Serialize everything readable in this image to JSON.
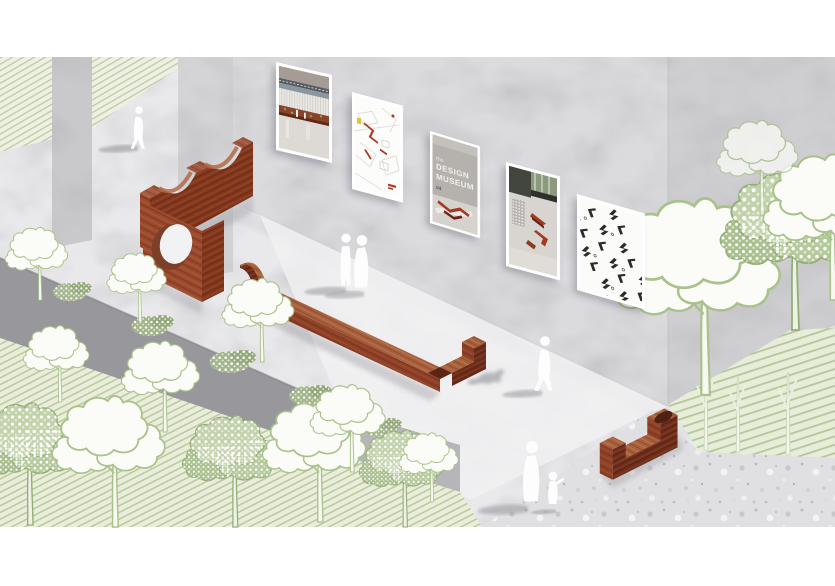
{
  "scene": {
    "description": "Axonometric architectural illustration of an outdoor Design Museum exhibition: brick arch furniture, long timber benches, poster gallery on a concrete wall, line-drawn trees and white visitor silhouettes",
    "style": "architectural collage rendering"
  },
  "wall_gallery": {
    "posters": [
      {
        "label": "interior perspective render with timber counter"
      },
      {
        "label": "site plan with red bench layout marks"
      },
      {
        "label": "museum concrete facade photo",
        "text_small": "the",
        "text_line1": "DESIGN",
        "text_line2": "MUSEUM",
        "text_tag": "#4"
      },
      {
        "label": "interior axonometric with red benches and dotted caption"
      },
      {
        "label": "bench module pattern specimen sheet"
      }
    ]
  },
  "objects": {
    "brick_arch_wall": "scalloped brick bench wall",
    "brick_hole_slab": "brick slab with circular opening",
    "long_bench": "long timber chaise bench with hook end",
    "hook_bench": "J-shaped timber bench"
  },
  "figures": [
    {
      "label": "person walking"
    },
    {
      "label": "couple standing"
    },
    {
      "label": "person walking a dog"
    },
    {
      "label": "adult with child"
    }
  ],
  "palette": {
    "wood_top": "#a8613f",
    "wood_front": "#8f4127",
    "wood_side": "#6f2e1c",
    "brick": "#9a4a2e",
    "foliage_outline": "#a9c18b",
    "hatch_line": "#b7c9a0",
    "concrete_wall": "#dbdbde",
    "terrazzo": "#e0e0e3",
    "trench": "#98989c",
    "figure_white": "#fdfdfe",
    "shadow": "#a2a2a7"
  }
}
